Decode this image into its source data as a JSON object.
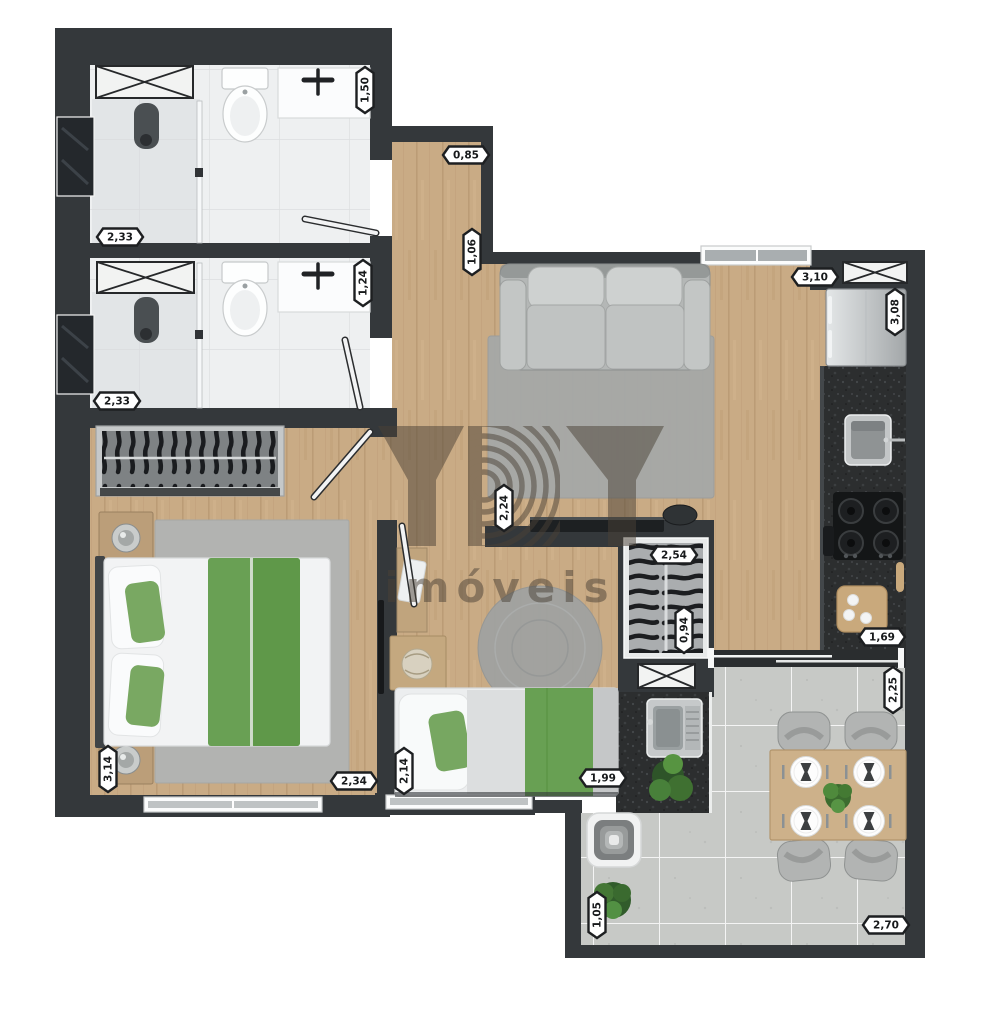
{
  "brand": {
    "name": "YBY",
    "subtitle": "imóveis"
  },
  "dimension_labels": [
    {
      "text": "1,50",
      "orientation": "vertical",
      "x": 365,
      "y": 90
    },
    {
      "text": "2,33",
      "orientation": "horizontal",
      "x": 120,
      "y": 237
    },
    {
      "text": "0,85",
      "orientation": "horizontal",
      "x": 466,
      "y": 155
    },
    {
      "text": "1,06",
      "orientation": "vertical",
      "x": 472,
      "y": 252
    },
    {
      "text": "3,10",
      "orientation": "horizontal",
      "x": 815,
      "y": 277
    },
    {
      "text": "3,08",
      "orientation": "vertical",
      "x": 895,
      "y": 312
    },
    {
      "text": "1,24",
      "orientation": "vertical",
      "x": 363,
      "y": 283
    },
    {
      "text": "2,33",
      "orientation": "horizontal",
      "x": 117,
      "y": 401
    },
    {
      "text": "2,24",
      "orientation": "vertical",
      "x": 504,
      "y": 508
    },
    {
      "text": "2,54",
      "orientation": "horizontal",
      "x": 674,
      "y": 555
    },
    {
      "text": "0,94",
      "orientation": "vertical",
      "x": 684,
      "y": 630
    },
    {
      "text": "1,69",
      "orientation": "horizontal",
      "x": 882,
      "y": 637
    },
    {
      "text": "2,25",
      "orientation": "vertical",
      "x": 893,
      "y": 690
    },
    {
      "text": "3,14",
      "orientation": "vertical",
      "x": 108,
      "y": 769
    },
    {
      "text": "2,34",
      "orientation": "horizontal",
      "x": 354,
      "y": 781
    },
    {
      "text": "2,14",
      "orientation": "vertical",
      "x": 404,
      "y": 771
    },
    {
      "text": "1,99",
      "orientation": "horizontal",
      "x": 603,
      "y": 778
    },
    {
      "text": "1,05",
      "orientation": "vertical",
      "x": 597,
      "y": 915
    },
    {
      "text": "2,70",
      "orientation": "horizontal",
      "x": 886,
      "y": 925
    }
  ],
  "colors": {
    "wall": "#34383b",
    "wood_floor": "#c9ab85",
    "bath_floor": "#eef0f1",
    "terrace_tile": "#c7c9c6",
    "granite": "#2c2e2f",
    "accent_green": "#69a054",
    "badge_bg": "#ffffff",
    "badge_border": "#1d1f21",
    "watermark": "#4a4136"
  },
  "fixtures": [
    "ventilation-shaft",
    "toilet",
    "washbasin-counter",
    "shower",
    "shower-glass",
    "bathroom-window",
    "wardrobe",
    "double-bed",
    "nightstand",
    "table-lamp",
    "rug",
    "wall-tv",
    "sofa",
    "tv-rack",
    "single-bed",
    "desk",
    "side-table",
    "round-rug",
    "clothes-closet",
    "laundry-sink",
    "refrigerator",
    "kitchen-sink",
    "cooktop",
    "cutting-board",
    "sliding-door",
    "window",
    "dining-table",
    "dining-chair",
    "plate-setting",
    "grill",
    "plant"
  ]
}
